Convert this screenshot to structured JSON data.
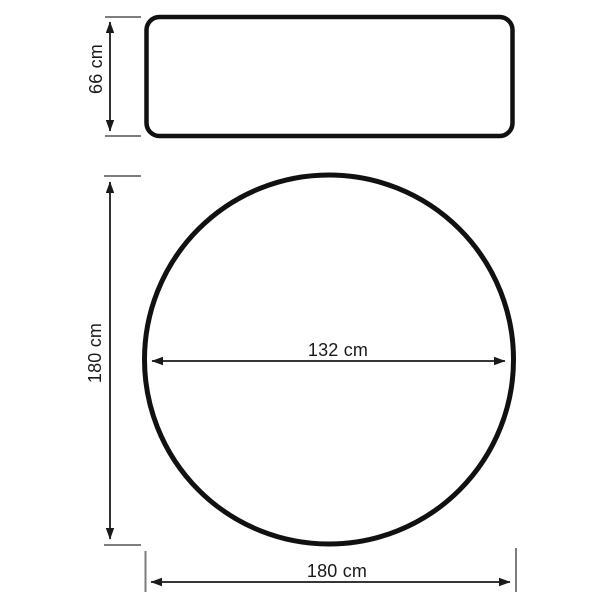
{
  "colors": {
    "outline": "#111111",
    "dimension_line": "#1a1a1a",
    "extension_tick": "#7d7d7d",
    "background": "#ffffff",
    "text": "#1a1a1a"
  },
  "side_view": {
    "height": {
      "label": "66 cm",
      "value": 66,
      "unit": "cm"
    }
  },
  "top_view": {
    "overall_height": {
      "label": "180 cm",
      "value": 180,
      "unit": "cm"
    },
    "inner_diameter": {
      "label": "132 cm",
      "value": 132,
      "unit": "cm"
    },
    "overall_width": {
      "label": "180 cm",
      "value": 180,
      "unit": "cm"
    }
  }
}
